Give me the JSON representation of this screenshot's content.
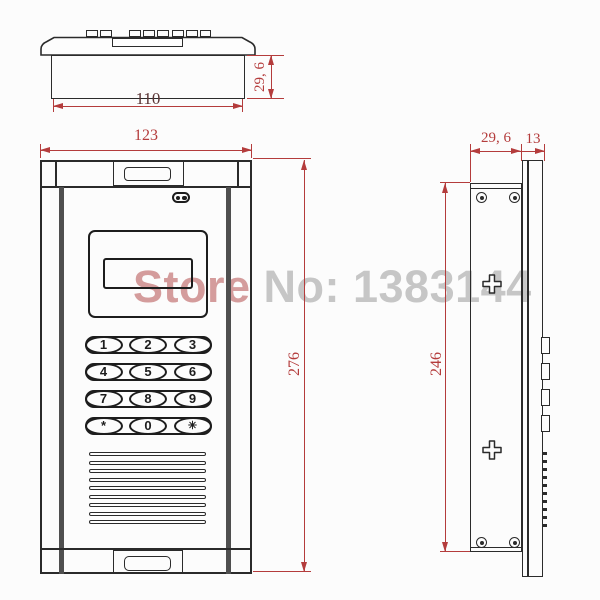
{
  "title": "door-intercom-keypad-dimension-drawing",
  "watermark": {
    "prefix": "Store",
    "suffix": " No: 1383144"
  },
  "colors": {
    "dimension_red": "#b43c3c",
    "dimension_dark": "#5a3434",
    "line_dark": "#2b2b2b",
    "watermark_prefix": "#d49c9c",
    "watermark_suffix": "#c6c6c6",
    "rail_gray": "#4f4f4f",
    "background": "#fcfcfc"
  },
  "views": {
    "top": {
      "dim_inner_width": "110",
      "dim_height": "29, 6"
    },
    "front": {
      "dim_width": "123",
      "dim_height": "276"
    },
    "side": {
      "dim_depth": "29, 6",
      "dim_back_box": "13",
      "dim_height": "246"
    }
  },
  "keypad": {
    "rows": [
      [
        "1",
        "2",
        "3"
      ],
      [
        "4",
        "5",
        "6"
      ],
      [
        "7",
        "8",
        "9"
      ],
      [
        "*",
        "0",
        "✳"
      ]
    ]
  },
  "icons": [
    "led-indicator-icon",
    "screw-icon",
    "mounting-cross-icon",
    "speaker-grille",
    "terminal-tabs"
  ]
}
